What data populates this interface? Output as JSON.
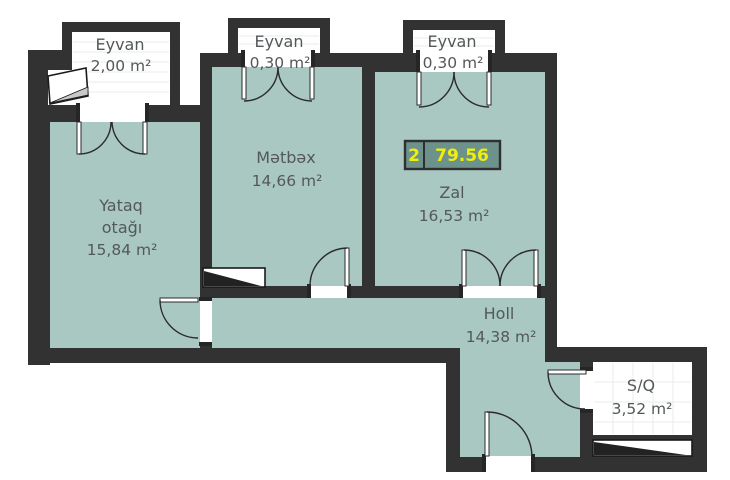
{
  "plan": {
    "colors": {
      "floor_teal": "#a9c8c1",
      "wall_dark": "#323232",
      "badge_fill": "#6d928b",
      "badge_text_yellow": "#f0ef0c",
      "label_gray": "#54585a"
    },
    "badge": {
      "value_left": "2",
      "value_right": "79.56"
    },
    "rooms": {
      "eyvan1": {
        "name": "Eyvan",
        "area": "2,00 m²"
      },
      "eyvan2": {
        "name": "Eyvan",
        "area": "0,30 m²"
      },
      "eyvan3": {
        "name": "Eyvan",
        "area": "0,30 m²"
      },
      "metbex": {
        "name": "Mətbəx",
        "area": "14,66 m²"
      },
      "zal": {
        "name": "Zal",
        "area": "16,53 m²"
      },
      "yataq": {
        "name_line1": "Yataq",
        "name_line2": "otağı",
        "area": "15,84 m²"
      },
      "holl": {
        "name": "Holl",
        "area": "14,38 m²"
      },
      "sq": {
        "name": "S/Q",
        "area": "3,52 m²"
      }
    }
  }
}
